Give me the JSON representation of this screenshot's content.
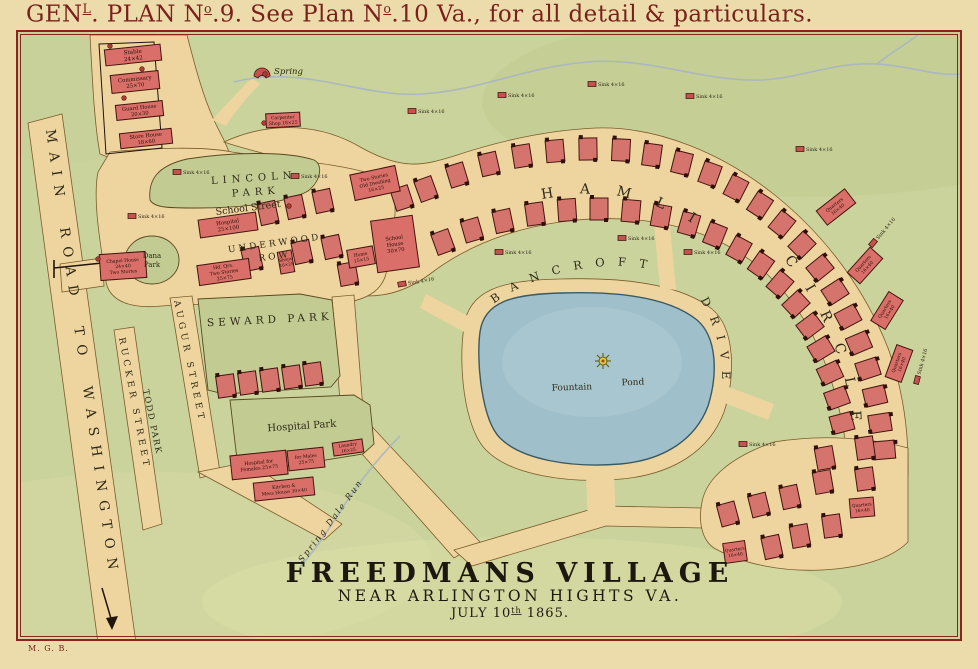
{
  "sheet": {
    "title": {
      "p1": "GEN",
      "sup1": "L",
      "p2": ". PLAN N",
      "sup2": "o",
      "p3": ".9. See Plan N",
      "sup3": "o",
      "p4": ".10 Va., for all detail & particulars."
    },
    "initials": "M. G. B."
  },
  "footer": {
    "line1": "FREEDMANS VILLAGE",
    "line2": "NEAR ARLINGTON HIGHTS VA.",
    "line3_p1": "JULY 10",
    "line3_sup": "th",
    "line3_p2": " 1865."
  },
  "streets": {
    "main_road": "MAIN ROAD TO WASHINGTON",
    "augur": "AUGUR STREET",
    "todd": "TODD PARK",
    "rucker": "RUCKER STREET",
    "school": "School Street",
    "underwood1": "UNDERWOOD",
    "underwood2": "ROW",
    "hamlin": "HAMLIN",
    "circle": "CIRCLE",
    "bancroft": "BANCROFT",
    "drive": "DRIVE",
    "spring_dale": "Spring Dale Run"
  },
  "parks": {
    "lincoln1": "LINCOLN",
    "lincoln2": "PARK",
    "dana1": "Dana",
    "dana2": "Park",
    "seward": "SEWARD PARK",
    "hospital": "Hospital Park",
    "pond1": "Fountain",
    "pond2": "Pond",
    "spring": "Spring"
  },
  "map": {
    "buildings": [
      {
        "name": "stable",
        "x": 103,
        "y": 45,
        "w": 56,
        "h": 16,
        "rot": -6,
        "fs": 5.6,
        "lines": [
          "Stable",
          "24×42"
        ]
      },
      {
        "name": "commissary",
        "x": 109,
        "y": 71,
        "w": 48,
        "h": 18,
        "rot": -6,
        "fs": 5.4,
        "lines": [
          "Commissary",
          "25×70"
        ]
      },
      {
        "name": "guard-house",
        "x": 114,
        "y": 101,
        "w": 47,
        "h": 15,
        "rot": -6,
        "fs": 5.2,
        "lines": [
          "Guard House",
          "20×30"
        ]
      },
      {
        "name": "store-house",
        "x": 118,
        "y": 129,
        "w": 52,
        "h": 15,
        "rot": -6,
        "fs": 5.2,
        "lines": [
          "Store House",
          "18×60"
        ]
      },
      {
        "name": "carpenter-shop",
        "x": 264,
        "y": 111,
        "w": 34,
        "h": 14,
        "rot": -3,
        "fs": 4.6,
        "lines": [
          "Carpenter",
          "Shop 18×25"
        ]
      },
      {
        "name": "hospital-school-street",
        "x": 197,
        "y": 214,
        "w": 58,
        "h": 18,
        "rot": -8,
        "fs": 5.4,
        "lines": [
          "Hospital",
          "25×100"
        ]
      },
      {
        "name": "head-quarters",
        "x": 196,
        "y": 260,
        "w": 52,
        "h": 20,
        "rot": -8,
        "fs": 4.8,
        "lines": [
          "Hd. Qrs.",
          "Two Stories",
          "25×75"
        ]
      },
      {
        "name": "old-dwelling",
        "x": 350,
        "y": 168,
        "w": 46,
        "h": 26,
        "rot": -12,
        "fs": 4.8,
        "lines": [
          "Two Stories",
          "Old Dwelling",
          "16×25"
        ]
      },
      {
        "name": "school-house",
        "x": 372,
        "y": 216,
        "w": 42,
        "h": 52,
        "rot": -8,
        "fs": 5.2,
        "lines": [
          "School",
          "House",
          "30×70"
        ]
      },
      {
        "name": "home-small",
        "x": 346,
        "y": 246,
        "w": 26,
        "h": 18,
        "rot": -10,
        "fs": 4.6,
        "lines": [
          "Home",
          "15×15"
        ]
      },
      {
        "name": "shops-row",
        "x": 277,
        "y": 249,
        "w": 14,
        "h": 22,
        "rot": -10,
        "fs": 4.2,
        "lines": [
          "Shops",
          "16×25"
        ]
      },
      {
        "name": "chapel-house",
        "x": 98,
        "y": 251,
        "w": 46,
        "h": 26,
        "rot": -4,
        "fs": 4.6,
        "lines": [
          "Chapel House",
          "24×40",
          "Two Stories"
        ]
      },
      {
        "name": "hospital-females",
        "x": 229,
        "y": 451,
        "w": 56,
        "h": 24,
        "rot": -6,
        "fs": 4.8,
        "lines": [
          "Hospital for",
          "Females 25×75"
        ]
      },
      {
        "name": "hospital-males",
        "x": 286,
        "y": 447,
        "w": 36,
        "h": 20,
        "rot": -6,
        "fs": 4.6,
        "lines": [
          "for Males",
          "25×75"
        ]
      },
      {
        "name": "kitchen-mess-house",
        "x": 252,
        "y": 478,
        "w": 60,
        "h": 18,
        "rot": -6,
        "fs": 4.6,
        "lines": [
          "Kitchen &",
          "Mess House 30×40"
        ]
      },
      {
        "name": "laundry",
        "x": 331,
        "y": 439,
        "w": 30,
        "h": 13,
        "rot": -8,
        "fs": 4.4,
        "lines": [
          "Laundry",
          "16×25"
        ]
      },
      {
        "name": "quarters-1",
        "x": 816,
        "y": 196,
        "w": 36,
        "h": 18,
        "rot": -38,
        "fs": 4.6,
        "lines": [
          "Quarters",
          "16×40"
        ]
      },
      {
        "name": "quarters-2",
        "x": 846,
        "y": 255,
        "w": 34,
        "h": 17,
        "rot": -48,
        "fs": 4.6,
        "lines": [
          "Quarters",
          "16×40"
        ]
      },
      {
        "name": "quarters-3",
        "x": 868,
        "y": 300,
        "w": 34,
        "h": 17,
        "rot": -58,
        "fs": 4.6,
        "lines": [
          "Quarters",
          "16×40"
        ]
      },
      {
        "name": "quarters-4",
        "x": 880,
        "y": 353,
        "w": 34,
        "h": 17,
        "rot": -70,
        "fs": 4.6,
        "lines": [
          "Quarters",
          "16×40"
        ]
      },
      {
        "name": "quarters-5",
        "x": 848,
        "y": 496,
        "w": 24,
        "h": 19,
        "rot": -5,
        "fs": 4.4,
        "lines": [
          "Quarters",
          "16×40"
        ]
      },
      {
        "name": "quarters-6",
        "x": 722,
        "y": 540,
        "w": 22,
        "h": 20,
        "rot": -8,
        "fs": 4.4,
        "lines": [
          "Quarters",
          "16×40"
        ]
      }
    ],
    "houses": [
      [
        266,
        211,
        -12
      ],
      [
        293,
        205,
        -12
      ],
      [
        321,
        199,
        -12
      ],
      [
        400,
        196,
        -18
      ],
      [
        250,
        257,
        -12
      ],
      [
        300,
        250,
        -12
      ],
      [
        330,
        245,
        -12
      ],
      [
        346,
        272,
        -10
      ],
      [
        224,
        384,
        -8
      ],
      [
        246,
        381,
        -8
      ],
      [
        268,
        378,
        -8
      ],
      [
        290,
        375,
        -8
      ],
      [
        311,
        372,
        -8
      ],
      [
        424,
        187,
        -20
      ],
      [
        455,
        173,
        -17
      ],
      [
        487,
        162,
        -13
      ],
      [
        520,
        154,
        -9
      ],
      [
        553,
        149,
        -5
      ],
      [
        586,
        147,
        -1
      ],
      [
        619,
        148,
        3
      ],
      [
        650,
        153,
        8
      ],
      [
        680,
        161,
        14
      ],
      [
        708,
        172,
        20
      ],
      [
        734,
        186,
        27
      ],
      [
        758,
        203,
        33
      ],
      [
        780,
        222,
        39
      ],
      [
        800,
        243,
        45
      ],
      [
        818,
        266,
        51
      ],
      [
        833,
        290,
        57
      ],
      [
        846,
        315,
        62
      ],
      [
        857,
        341,
        67
      ],
      [
        866,
        367,
        72
      ],
      [
        873,
        394,
        77
      ],
      [
        878,
        421,
        81
      ],
      [
        882,
        448,
        85
      ],
      [
        441,
        240,
        -20
      ],
      [
        470,
        228,
        -16
      ],
      [
        501,
        219,
        -12
      ],
      [
        533,
        212,
        -8
      ],
      [
        565,
        208,
        -4
      ],
      [
        597,
        207,
        0
      ],
      [
        629,
        209,
        5
      ],
      [
        659,
        214,
        10
      ],
      [
        687,
        222,
        16
      ],
      [
        713,
        233,
        22
      ],
      [
        737,
        247,
        29
      ],
      [
        759,
        263,
        35
      ],
      [
        778,
        282,
        41
      ],
      [
        794,
        302,
        47
      ],
      [
        808,
        324,
        53
      ],
      [
        819,
        347,
        59
      ],
      [
        828,
        371,
        65
      ],
      [
        835,
        396,
        70
      ],
      [
        840,
        421,
        75
      ],
      [
        823,
        456,
        -10
      ],
      [
        863,
        446,
        -8
      ],
      [
        863,
        477,
        -8
      ],
      [
        821,
        480,
        -10
      ],
      [
        788,
        495,
        -12
      ],
      [
        757,
        503,
        -14
      ],
      [
        726,
        512,
        -15
      ],
      [
        830,
        524,
        -8
      ],
      [
        798,
        534,
        -10
      ],
      [
        770,
        545,
        -12
      ]
    ],
    "sinks": {
      "label": "Sink 4×16",
      "items": [
        [
          175,
          170,
          0
        ],
        [
          293,
          174,
          0
        ],
        [
          130,
          214,
          0
        ],
        [
          410,
          109,
          0
        ],
        [
          500,
          93,
          0
        ],
        [
          590,
          82,
          0
        ],
        [
          688,
          94,
          0
        ],
        [
          798,
          147,
          0
        ],
        [
          497,
          250,
          0
        ],
        [
          620,
          236,
          0
        ],
        [
          686,
          250,
          0
        ],
        [
          871,
          241,
          -50
        ],
        [
          741,
          442,
          0
        ],
        [
          915,
          378,
          -75
        ],
        [
          400,
          282,
          -10
        ]
      ]
    },
    "dots": [
      [
        108,
        44
      ],
      [
        140,
        67
      ],
      [
        122,
        96
      ],
      [
        262,
        121
      ],
      [
        96,
        257
      ],
      [
        287,
        204
      ],
      [
        263,
        72
      ]
    ]
  },
  "colors": {
    "paper": "#ecdcab",
    "map_green": "#cbd39c",
    "road_tan": "#eed49e",
    "pond_blue": "#9fbfca",
    "building_red": "#d96f68",
    "frame_maroon": "#8a2420",
    "title_maroon": "#7b1f1b"
  }
}
